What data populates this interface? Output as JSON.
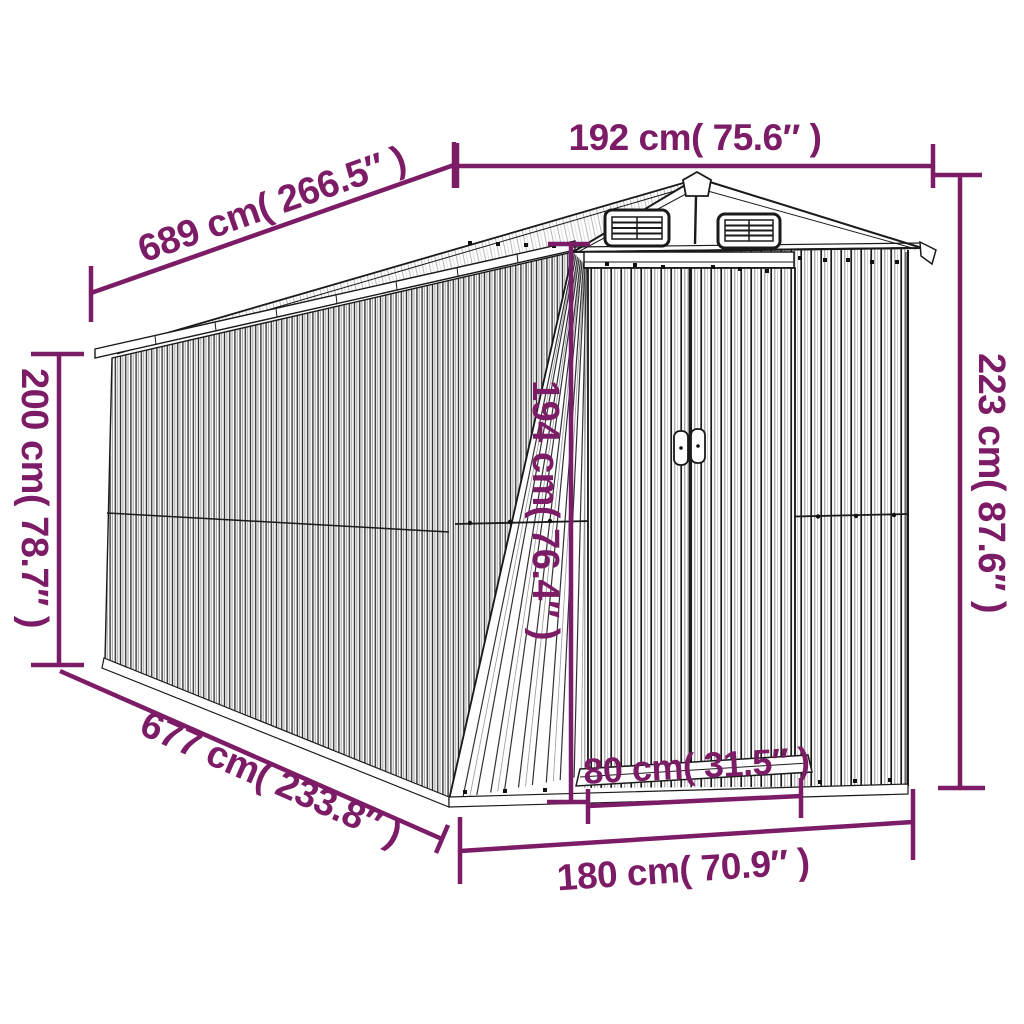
{
  "diagram": {
    "subject": "Garden shed perspective line drawing with dimension annotations",
    "accent_color": "#7D1C66",
    "line_color": "#1a1a1a",
    "dimensions": {
      "roof_length": "689 cm( 266.5″ )",
      "front_width": "192 cm( 75.6″ )",
      "side_height": "200 cm( 78.7″ )",
      "total_height": "223 cm( 87.6″ )",
      "door_height": "194 cm( 76.4″ )",
      "base_length": "677 cm( 233.8″ )",
      "door_width": "80 cm( 31.5″ )",
      "base_width": "180 cm( 70.9″ )"
    }
  }
}
